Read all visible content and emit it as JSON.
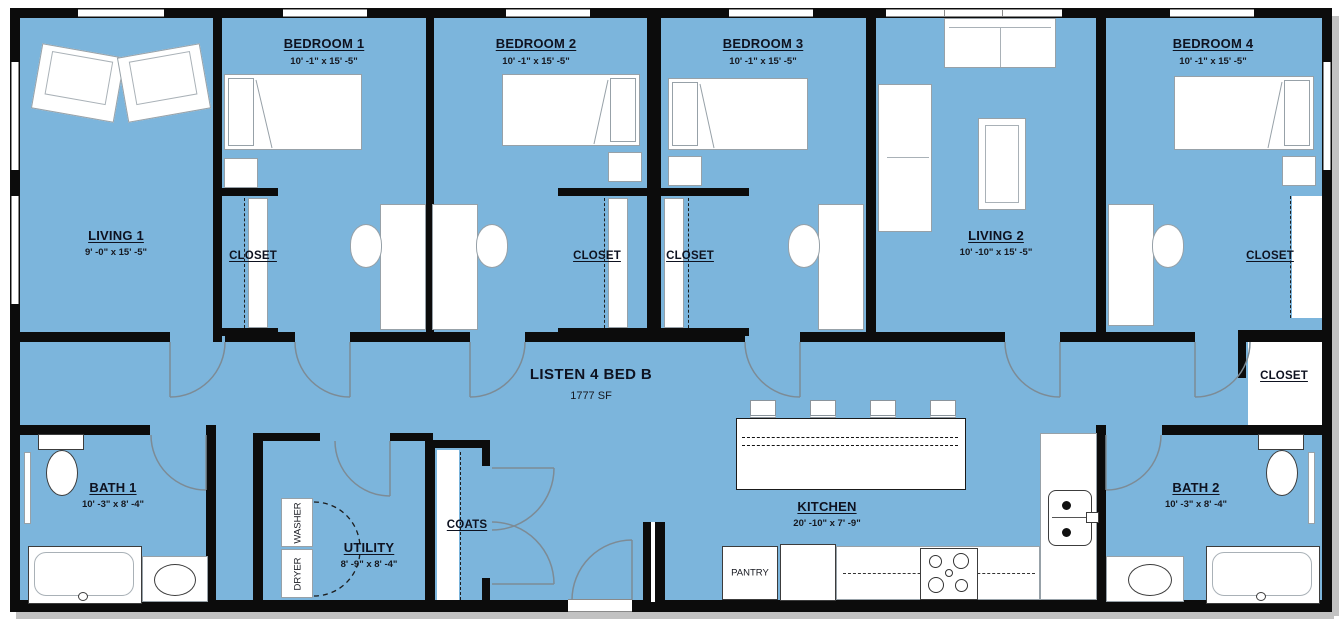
{
  "plan": {
    "title": "LISTEN 4 BED B",
    "area": "1777 SF"
  },
  "colors": {
    "floor": "#7cb5dc",
    "wall": "#0c0c0c"
  },
  "rooms": {
    "living1": {
      "label": "LIVING 1",
      "dims": "9' -0\" x 15' -5\""
    },
    "bedroom1": {
      "label": "BEDROOM 1",
      "dims": "10' -1\" x 15' -5\""
    },
    "bedroom2": {
      "label": "BEDROOM 2",
      "dims": "10' -1\" x 15' -5\""
    },
    "bedroom3": {
      "label": "BEDROOM 3",
      "dims": "10' -1\" x 15' -5\""
    },
    "living2": {
      "label": "LIVING 2",
      "dims": "10' -10\" x 15' -5\""
    },
    "bedroom4": {
      "label": "BEDROOM 4",
      "dims": "10' -1\" x 15' -5\""
    },
    "bath1": {
      "label": "BATH 1",
      "dims": "10' -3\" x 8' -4\""
    },
    "bath2": {
      "label": "BATH 2",
      "dims": "10' -3\" x 8' -4\""
    },
    "utility": {
      "label": "UTILITY",
      "dims": "8' -9\" x 8' -4\""
    },
    "kitchen": {
      "label": "KITCHEN",
      "dims": "20' -10\" x 7' -9\""
    },
    "coats": {
      "label": "COATS"
    },
    "pantry": {
      "label": "PANTRY"
    }
  },
  "closets": [
    "CLOSET",
    "CLOSET",
    "CLOSET",
    "CLOSET",
    "CLOSET"
  ],
  "appliances": {
    "washer": "WASHER",
    "dryer": "DRYER"
  }
}
